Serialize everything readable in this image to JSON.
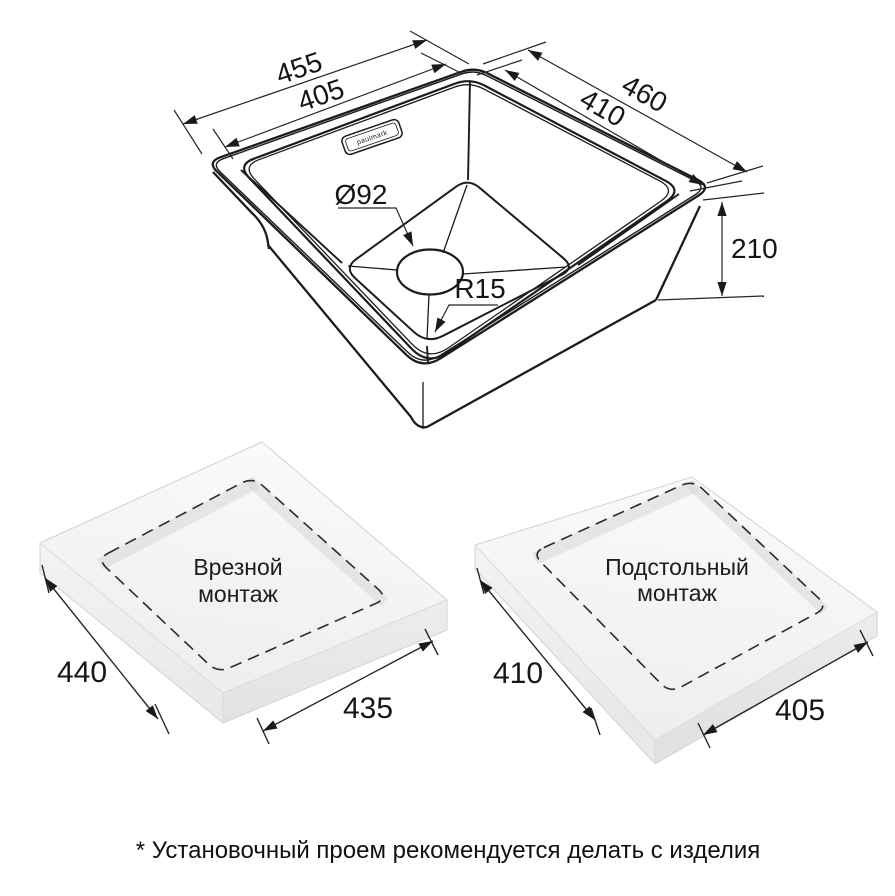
{
  "sink_drawing": {
    "brand_label": "paulmark",
    "dim_rim_width": "455",
    "dim_bowl_width": "405",
    "dim_rim_depth": "460",
    "dim_bowl_depth": "410",
    "dim_height": "210",
    "dim_drain": "Ø92",
    "dim_corner_radius": "R15"
  },
  "mount_inset": {
    "title_line1": "Врезной",
    "title_line2": "монтаж",
    "dim_side": "440",
    "dim_front": "435"
  },
  "mount_under": {
    "title_line1": "Подстольный",
    "title_line2": "монтаж",
    "dim_side": "410",
    "dim_front": "405"
  },
  "footnote": "* Установочный проем рекомендуется делать с изделия",
  "colors": {
    "line": "#1c1c1c",
    "dim_line": "#262626",
    "slab_top": "#f7f7f7",
    "slab_left": "#efefef",
    "slab_right": "#e6e6e6",
    "cutout_shadow": "#d7d7d7"
  }
}
